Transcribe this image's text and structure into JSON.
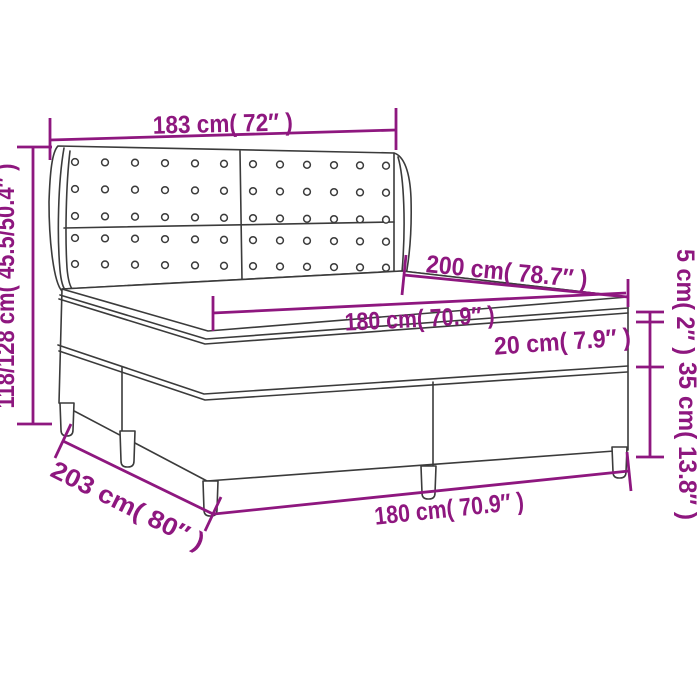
{
  "title": "Box spring bed with headboard - dimension diagram",
  "colors": {
    "dimension": "#8E177F",
    "outline": "#3B3B3B",
    "background": "#FFFFFF"
  },
  "labels": {
    "headboard_width": "183 cm( 72″ )",
    "overall_height": "118/128 cm( 45.5/50.4″ )",
    "bed_length_top": "200 cm( 78.7″ )",
    "sleep_width_top": "180 cm( 70.9″ )",
    "mattress_height": "20 cm( 7.9″ )",
    "topper_height": "5 cm( 2″ )",
    "base_height": "35 cm( 13.8″ )",
    "base_length": "203 cm( 80″ )",
    "base_width": "180 cm( 70.9″ )"
  },
  "illustration": {
    "button_rows": 5,
    "button_cols": 12
  }
}
